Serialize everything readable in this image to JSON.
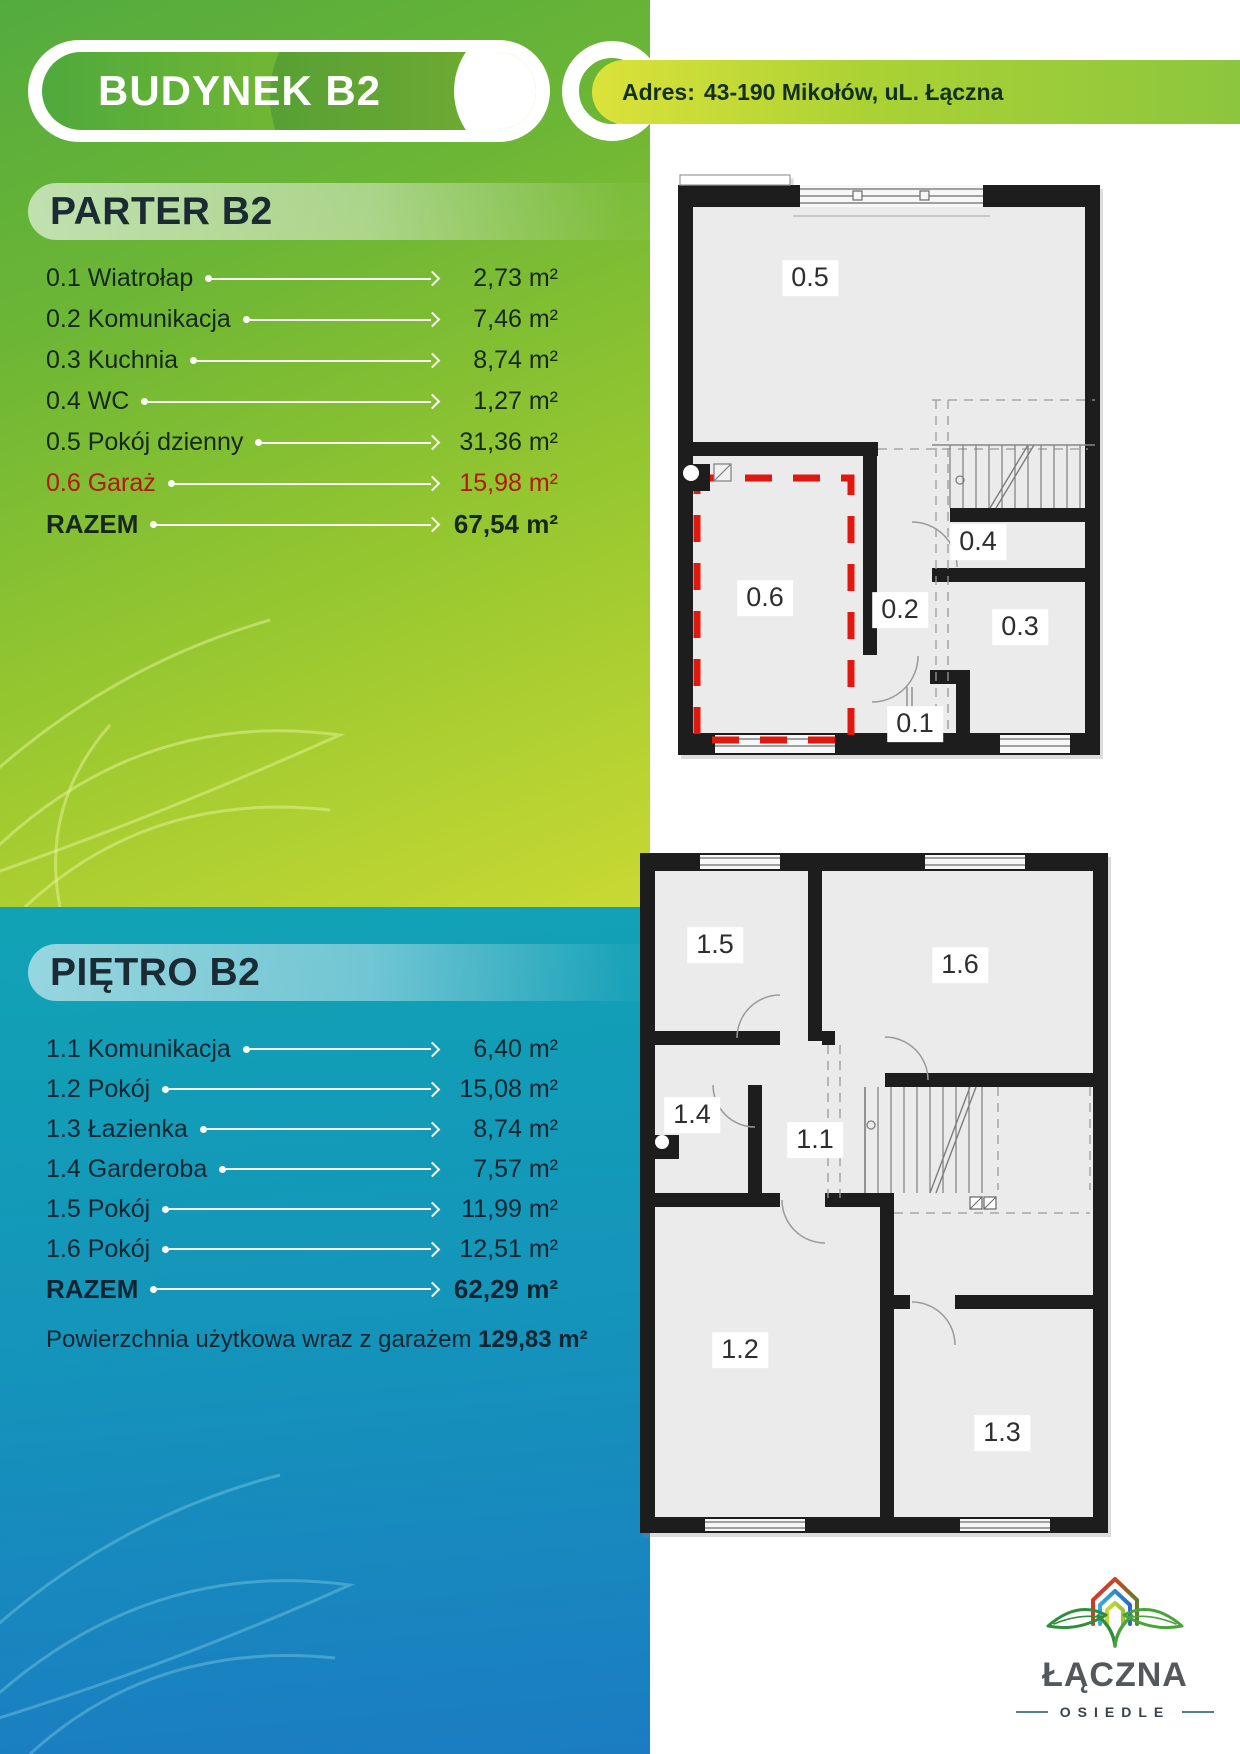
{
  "header": {
    "building": "BUDYNEK B2",
    "address_label": "Adres:",
    "address": "43-190 Mikołów, uL. Łączna"
  },
  "parter": {
    "title": "PARTER B2",
    "rows": [
      {
        "label": "0.1 Wiatrołap",
        "area": "2,73 m²"
      },
      {
        "label": "0.2 Komunikacja",
        "area": "7,46 m²"
      },
      {
        "label": "0.3 Kuchnia",
        "area": "8,74 m²"
      },
      {
        "label": "0.4 WC",
        "area": "1,27 m²"
      },
      {
        "label": "0.5 Pokój dzienny",
        "area": "31,36 m²"
      },
      {
        "label": "0.6 Garaż",
        "area": "15,98 m²"
      }
    ],
    "total": {
      "label": "RAZEM",
      "area": "67,54 m²"
    }
  },
  "pietro": {
    "title": "PIĘTRO B2",
    "rows": [
      {
        "label": "1.1 Komunikacja",
        "area": "6,40 m²"
      },
      {
        "label": "1.2 Pokój",
        "area": "15,08 m²"
      },
      {
        "label": "1.3 Łazienka",
        "area": "8,74 m²"
      },
      {
        "label": "1.4 Garderoba",
        "area": "7,57 m²"
      },
      {
        "label": "1.5 Pokój",
        "area": "11,99 m²"
      },
      {
        "label": "1.6 Pokój",
        "area": "12,51 m²"
      }
    ],
    "total": {
      "label": "RAZEM",
      "area": "62,29 m²"
    },
    "summary": {
      "label": "Powierzchnia użytkowa wraz z garażem",
      "area": "129,83 m²"
    }
  },
  "plans": {
    "ground": {
      "labels": {
        "r05": "0.5",
        "r04": "0.4",
        "r06": "0.6",
        "r02": "0.2",
        "r03": "0.3",
        "r01": "0.1"
      }
    },
    "first": {
      "labels": {
        "r15": "1.5",
        "r16": "1.6",
        "r14": "1.4",
        "r11": "1.1",
        "r12": "1.2",
        "r13": "1.3"
      }
    }
  },
  "logo": {
    "name": "ŁĄCZNA",
    "subtitle": "OSIEDLE"
  },
  "colors": {
    "accent_green": "#8cc63e",
    "accent_teal": "#16a5b5",
    "accent_blue": "#1b7cc2",
    "garage_red": "#b2180e",
    "plan_red_dash": "#e0180f"
  }
}
